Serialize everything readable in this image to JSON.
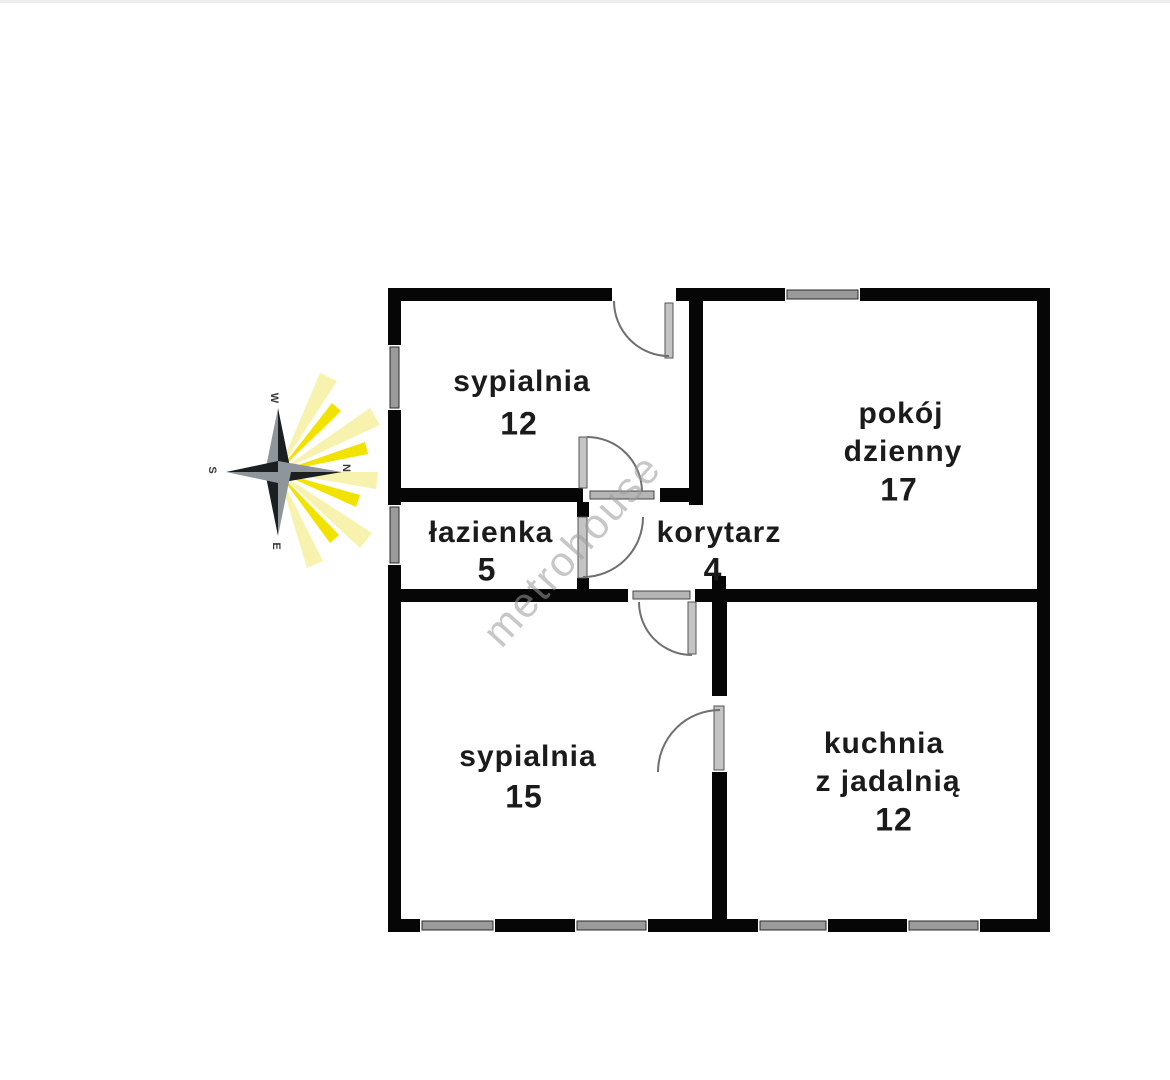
{
  "watermark": {
    "text": "metrohouse",
    "color": "#9b9b9b"
  },
  "compass": {
    "letters": {
      "top": "W",
      "right": "N",
      "bottom": "E",
      "left": "S"
    },
    "ray_bright": "#f2e200",
    "ray_pale": "#f7f3ae",
    "star_dark": "#1b1f22",
    "star_gray": "#8e959b"
  },
  "rooms": [
    {
      "key": "sypialnia-gorna",
      "name": "sypialnia",
      "area": "12"
    },
    {
      "key": "pokoj-dzienny",
      "name": "pokój",
      "name2": "dzienny",
      "area": "17"
    },
    {
      "key": "lazienka",
      "name": "łazienka",
      "area": "5"
    },
    {
      "key": "korytarz",
      "name": "korytarz",
      "area": "4"
    },
    {
      "key": "sypialnia-dolna",
      "name": "sypialnia",
      "area": "15"
    },
    {
      "key": "kuchnia",
      "name": "kuchnia",
      "name2": "z jadalnią",
      "area": "12"
    }
  ],
  "colors": {
    "wall": "#060606",
    "window": "#9a9a9a",
    "door_arc": "#6f6f6f",
    "door_leaf": "#c4c4c4",
    "label": "#1b1b1b"
  }
}
